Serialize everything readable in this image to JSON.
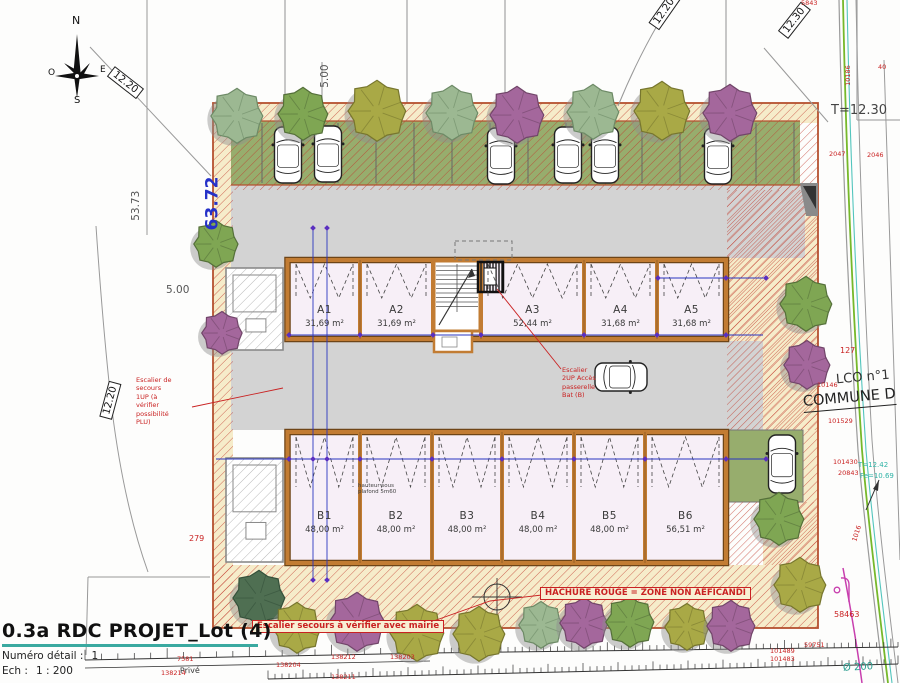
{
  "title_block": {
    "title": "0.3a RDC PROJET_Lot (4)",
    "detail_label": "Numéro détail :",
    "detail_value": "1",
    "scale_label": "Ech :",
    "scale_value": "1 : 200"
  },
  "compass": {
    "north": "N",
    "east": "E",
    "south": "S",
    "west": "O"
  },
  "dimensions": {
    "west_total": "63.72",
    "north_offset": "53.73",
    "d1220_nw": "12.20",
    "d1220_w": "12.20",
    "d1220_top": "12.20",
    "d1230_ne": "12.30",
    "d500_top": "5.00",
    "d500_left": "5.00",
    "t_level": "T=12.30"
  },
  "buildings": {
    "a": {
      "units": [
        {
          "name": "A1",
          "area": "31,69 m²"
        },
        {
          "name": "A2",
          "area": "31,69 m²"
        },
        {
          "name": "A3",
          "area": "52,44 m²"
        },
        {
          "name": "A4",
          "area": "31,68 m²"
        },
        {
          "name": "A5",
          "area": "31,68 m²"
        }
      ]
    },
    "b": {
      "units": [
        {
          "name": "B1",
          "area": "48,00 m²"
        },
        {
          "name": "B2",
          "area": "48,00 m²"
        },
        {
          "name": "B3",
          "area": "48,00 m²"
        },
        {
          "name": "B4",
          "area": "48,00 m²"
        },
        {
          "name": "B5",
          "area": "48,00 m²"
        },
        {
          "name": "B6",
          "area": "56,51 m²"
        }
      ],
      "ceiling_note": "hauteur sous\nplafond 5m60"
    }
  },
  "annotations": {
    "legend": "HACHURE ROUGE = ZONE NON AEFICANDI",
    "stair_bottom": "Escalier secours à vérifier avec mairie",
    "stair_left": "Escalier de\nsecours\n1UP (à\nvérifier\npossibilité\nPLU)",
    "stair_mid": "Escalier\n2UP Accès\npasserelle\nBat (B)"
  },
  "street": {
    "lco": "LCO n°1",
    "commune": "COMMUNE D",
    "t_level2": "T=12.42",
    "fe_level": "Fe=10.69",
    "diameter": "Ø 200",
    "prive": "Privé"
  },
  "survey_points": [
    "5843",
    "10186",
    "2047",
    "2046",
    "127",
    "10146",
    "101529",
    "101430",
    "20843",
    "1016",
    "58463",
    "101489",
    "101483",
    "59751",
    "279",
    "138212",
    "138204",
    "138203",
    "138214",
    "138211",
    "7581",
    "40"
  ],
  "colors": {
    "hatch_red": "#c0392b",
    "wall_orange": "#c27c33",
    "floor_lavender": "#f7eff7",
    "parking_green": "#97ad6d",
    "driveway_gray": "#d3d3d3",
    "band_cream": "#f6ecca",
    "dim_blue": "#2a35c0",
    "survey_red": "#cc2222",
    "road_green": "#76b82a",
    "road_cyan": "#52c5bd",
    "utility_magenta": "#c83fae",
    "title_teal": "#3aa9a0"
  }
}
